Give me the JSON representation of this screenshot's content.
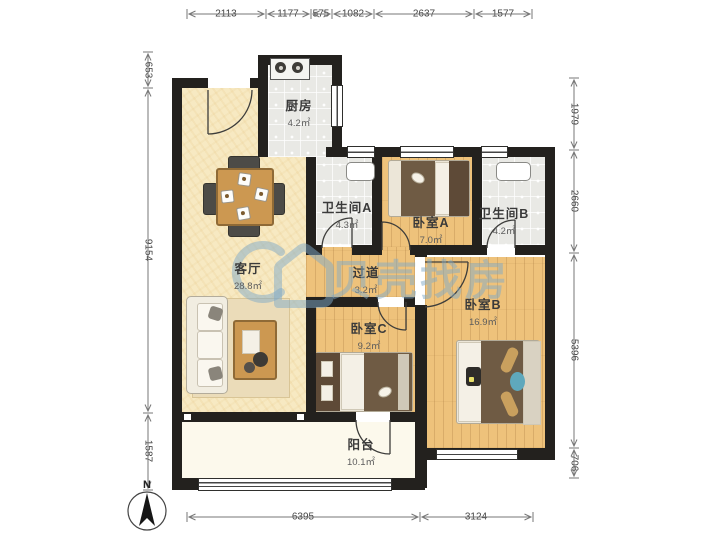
{
  "watermark": {
    "text": "贝壳找房"
  },
  "compass": {
    "label": "N"
  },
  "rooms": [
    {
      "name": "厨房",
      "area": "4.2㎡"
    },
    {
      "name": "卫生间A",
      "area": "4.3㎡"
    },
    {
      "name": "卧室A",
      "area": "7.0㎡"
    },
    {
      "name": "卫生间B",
      "area": "4.2㎡"
    },
    {
      "name": "客厅",
      "area": "28.8㎡"
    },
    {
      "name": "过道",
      "area": "3.2㎡"
    },
    {
      "name": "卧室C",
      "area": "9.2㎡"
    },
    {
      "name": "卧室B",
      "area": "16.9㎡"
    },
    {
      "name": "阳台",
      "area": "10.1㎡"
    }
  ],
  "dimensions": {
    "top": [
      "2113",
      "1177",
      "575",
      "1082",
      "2637",
      "1577"
    ],
    "left": [
      "653",
      "9154",
      "1587"
    ],
    "right": [
      "1979",
      "2660",
      "5396",
      "706"
    ],
    "bottom": [
      "6395",
      "3124"
    ]
  },
  "colors": {
    "wall": "#23211e",
    "wood_floor": "#eec27b",
    "living_floor": "#f7e9c2",
    "tile_floor": "#e9e9e5",
    "balcony_floor": "#fcf9ec",
    "watermark_blue": "#7faac8"
  }
}
